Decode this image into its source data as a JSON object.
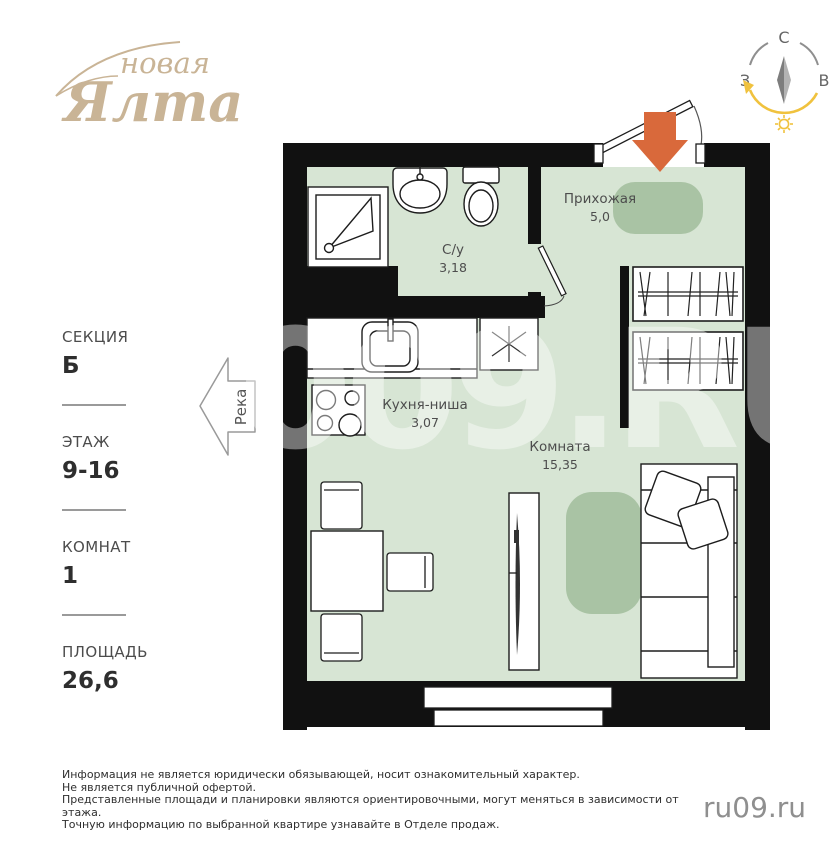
{
  "logo": {
    "word1": "новая",
    "word2": "Ялта"
  },
  "compass": {
    "north": "С",
    "west": "З",
    "east": "В"
  },
  "sidebar": {
    "items": [
      {
        "label": "СЕКЦИЯ",
        "value": "Б"
      },
      {
        "label": "ЭТАЖ",
        "value": "9-16"
      },
      {
        "label": "КОМНАТ",
        "value": "1"
      },
      {
        "label": "ПЛОЩАДЬ",
        "value": "26,6"
      }
    ]
  },
  "river": {
    "label": "Река"
  },
  "plan": {
    "rooms": [
      {
        "name": "Прихожая",
        "area": "5,0"
      },
      {
        "name": "С/у",
        "area": "3,18"
      },
      {
        "name": "Кухня-ниша",
        "area": "3,07"
      },
      {
        "name": "Комната",
        "area": "15,35"
      }
    ]
  },
  "watermark": "009.RU",
  "disclaimer": {
    "lines": [
      "Информация не является юридически обязывающей, носит ознакомительный характер.",
      "Не является публичной офертой.",
      "Представленные площади и планировки являются ориентировочными, могут меняться в зависимости от этажа.",
      "Точную информацию по выбранной квартире узнавайте в Отделе продаж."
    ]
  },
  "footer": {
    "site": "ru09.ru"
  },
  "colors": {
    "floor_green": "#d7e5d4",
    "zone_green": "#a9c3a4",
    "wall_black": "#111111",
    "accent_orange": "#d9693b",
    "brand_beige": "#c9b496",
    "compass_gold": "#f0c23e"
  }
}
